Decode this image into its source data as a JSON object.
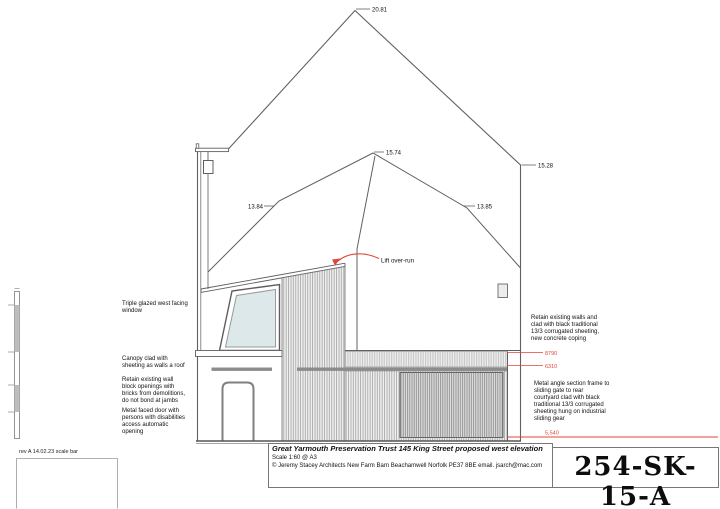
{
  "drawing": {
    "dimensions": {
      "ridge": "20.81",
      "inner_ridge": "15.74",
      "right_eave": "15.28",
      "left_slope": "13.84",
      "right_slope": "13.85"
    },
    "levels": {
      "coping": "8790",
      "mid": "6310",
      "ground": "5,540"
    },
    "lift_label": "Lift over-run",
    "callouts": {
      "left": [
        "Triple glazed west facing window",
        "Canopy clad with sheeting as walls a roof",
        "Retain existing wall block openings with bricks from demolitions, do not bond at  jambs",
        "Metal faced door with persons with disabilities access automatic opening"
      ],
      "right": [
        "Retain existing walls and clad with black traditional 13/3 corrugated sheeting, new concrete coping",
        "Metal angle section frame to sliding gate to rear courtyard clad with black traditional 13/3 corrugated sheeting hung on industrial sliding gear"
      ]
    }
  },
  "title_block": {
    "title": "Great Yarmouth Preservation Trust 145 King Street proposed west elevation",
    "scale": "Scale 1:60 @ A3",
    "copyright": "© Jeremy Stacey Architects New Farm Barn Beachamwell Norfolk PE37 8BE email. jsarch@mac.com",
    "drawing_number": "254-SK-15-A"
  },
  "revision_note": "rev A 14.02.23 scale bar",
  "colors": {
    "line": "#606060",
    "red": "#e2453a",
    "glazing": "#dde8ea"
  }
}
